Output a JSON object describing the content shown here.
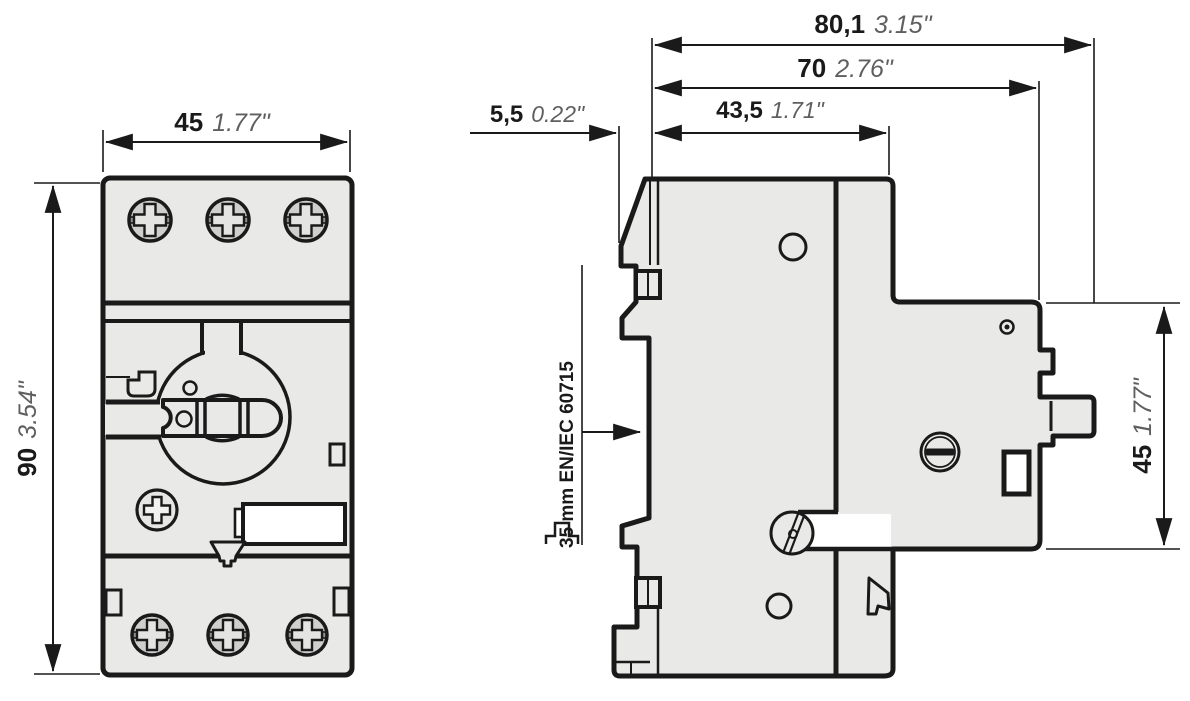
{
  "meta": {
    "title": "Motor protective circuit breaker - dimension drawing"
  },
  "colors": {
    "body_fill": "#e9e9e8",
    "line": "#1a1a1a",
    "inch_text": "#5f5f5f"
  },
  "front_view": {
    "width": {
      "mm": "45",
      "inch": "1.77\""
    },
    "height": {
      "mm": "90",
      "inch": "3.54\""
    }
  },
  "side_view": {
    "total_depth": {
      "mm": "80,1",
      "inch": "3.15\""
    },
    "depth_to_handle_base": {
      "mm": "70",
      "inch": "2.76\""
    },
    "rail_offset": {
      "mm": "5,5",
      "inch": "0.22\""
    },
    "upper_body_depth": {
      "mm": "43,5",
      "inch": "1.71\""
    },
    "front_section_height": {
      "mm": "45",
      "inch": "1.77\""
    },
    "din_rail_label": "35 mm EN/IEC 60715"
  }
}
